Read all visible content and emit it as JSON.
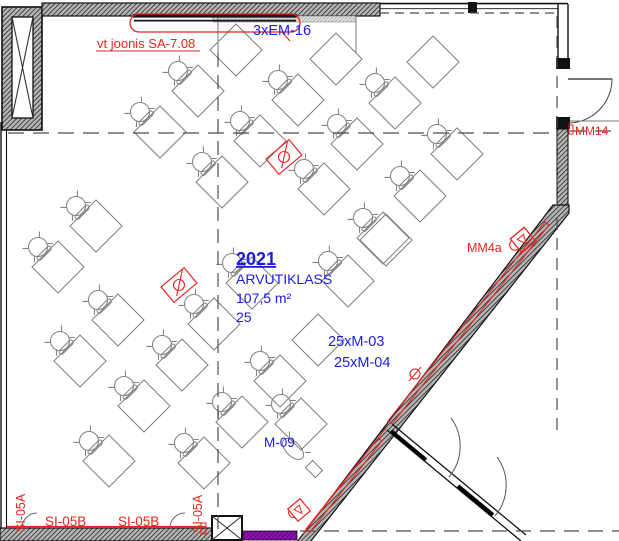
{
  "drawing": {
    "room": {
      "number": "2021",
      "name": "ARVUTIKLASS",
      "area": "107,5 m²",
      "seat_count": "25"
    },
    "annotations": {
      "em_label": "3xEM-16",
      "monitor_label_1": "25xM-03",
      "monitor_label_2": "25xM-04",
      "m09_label": "M-09",
      "mm14_label": "MM14",
      "mm4a_label": "MM4a",
      "ref_note": "vt joonis SA-7.08",
      "si_b1": "SI-05B",
      "si_b2": "SI-05B",
      "si_a1": "SI-05A",
      "si_a2": "SI-05A"
    },
    "colors": {
      "annotation_red": "#e8251f",
      "annotation_blue": "#1c1ce6",
      "wall_purple": "#8d12b4",
      "desk_gray": "#828282"
    },
    "furniture": {
      "table_half": 18.4,
      "strips": [
        {
          "tables": [
            [
              160,
              132
            ],
            [
              198,
              91
            ],
            [
              236,
              50
            ]
          ],
          "chairs": [
            true,
            true,
            false
          ]
        },
        {
          "tables": [
            [
              58,
              267
            ],
            [
              96,
              226
            ]
          ],
          "chairs": [
            true,
            true
          ]
        },
        {
          "tables": [
            [
              222,
              182
            ],
            [
              260,
              141
            ],
            [
              298,
              100
            ],
            [
              336,
              59
            ]
          ],
          "chairs": [
            true,
            true,
            true,
            false
          ]
        },
        {
          "tables": [
            [
              80,
              361
            ],
            [
              118,
              320
            ]
          ],
          "chairs": [
            true,
            true
          ]
        },
        {
          "tables": [
            [
              357,
              144
            ],
            [
              395,
              103
            ],
            [
              433,
              62
            ]
          ],
          "chairs": [
            true,
            true,
            false
          ]
        },
        {
          "tables": [
            [
              383,
              238
            ],
            [
              420,
              196
            ],
            [
              457,
              154
            ]
          ],
          "chairs": [
            true,
            true,
            true
          ]
        },
        {
          "tables": [
            [
              324,
              189
            ]
          ],
          "chairs": [
            true
          ]
        },
        {
          "tables": [
            [
              144,
              406
            ],
            [
              182,
              365
            ]
          ],
          "chairs": [
            true,
            true
          ]
        },
        {
          "tables": [
            [
              214,
              324
            ],
            [
              252,
              283
            ]
          ],
          "chairs": [
            true,
            true
          ]
        },
        {
          "tables": [
            [
              204,
              463
            ],
            [
              242,
              422
            ],
            [
              280,
              381
            ],
            [
              318,
              340
            ]
          ],
          "chairs": [
            true,
            true,
            true,
            false
          ]
        },
        {
          "tables": [
            [
              109,
              461
            ]
          ],
          "chairs": [
            true
          ]
        },
        {
          "tables": [
            [
              348,
              281
            ],
            [
              386,
              240
            ]
          ],
          "chairs": [
            true,
            false
          ]
        },
        {
          "tables": [
            [
              301,
              424
            ]
          ],
          "chairs": [
            true
          ]
        }
      ],
      "outlets": [
        [
          284,
          157
        ],
        [
          179,
          285
        ]
      ],
      "teacher": {
        "seat_ellipse": [
          293,
          449
        ],
        "gear_box": [
          314,
          469
        ]
      }
    }
  }
}
